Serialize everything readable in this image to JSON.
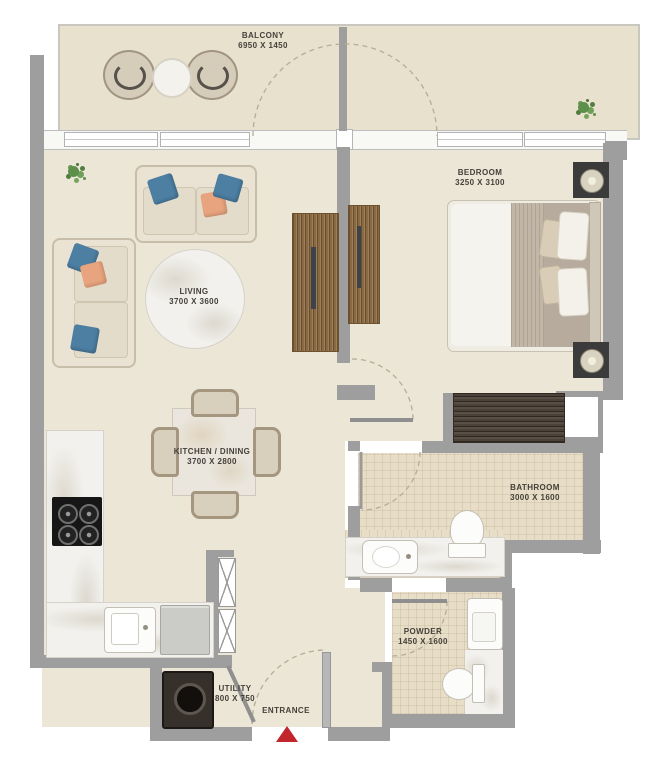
{
  "rooms": {
    "balcony": {
      "name": "BALCONY",
      "dims": "6950 X 1450"
    },
    "bedroom": {
      "name": "BEDROOM",
      "dims": "3250 X 3100"
    },
    "living": {
      "name": "LIVING",
      "dims": "3700 X 3600"
    },
    "kitchen_dining": {
      "name": "KITCHEN / DINING",
      "dims": "3700 X 2800"
    },
    "bathroom": {
      "name": "BATHROOM",
      "dims": "3000 X 1600"
    },
    "powder": {
      "name": "POWDER",
      "dims": "1450 X 1600"
    },
    "utility": {
      "name": "UTILITY",
      "dims": "800 X 750"
    },
    "entrance": {
      "name": "ENTRANCE"
    }
  },
  "colors": {
    "wall": "#9e9e9e",
    "floor": "#ece6d6",
    "balcony_floor": "#e8e1ce",
    "tile_floor": "#e8ddc7",
    "wood": "#8a6a45",
    "dark_wood": "#4c4238",
    "marble": "#f2f1ed",
    "pillow_blue": "#4d7fa3",
    "pillow_orange": "#e8a47e",
    "entrance_arrow": "#c0262c",
    "plant_green": "#5c8f4a"
  },
  "fixtures": [
    "balcony-chairs",
    "balcony-round-table",
    "plants",
    "living-sofas",
    "round-marble-rug",
    "tv-units",
    "double-bed",
    "nightstands-with-lamps",
    "bedroom-wardrobe",
    "dining-table-with-4-chairs",
    "kitchen-counter",
    "stove-4-burners",
    "kitchen-sink",
    "fridge",
    "bathroom-toilet",
    "bathroom-vanity-sink",
    "powder-toilet",
    "powder-sink",
    "washing-machine",
    "entrance-arrow",
    "door-swing-arcs",
    "shaft-x-closets"
  ]
}
